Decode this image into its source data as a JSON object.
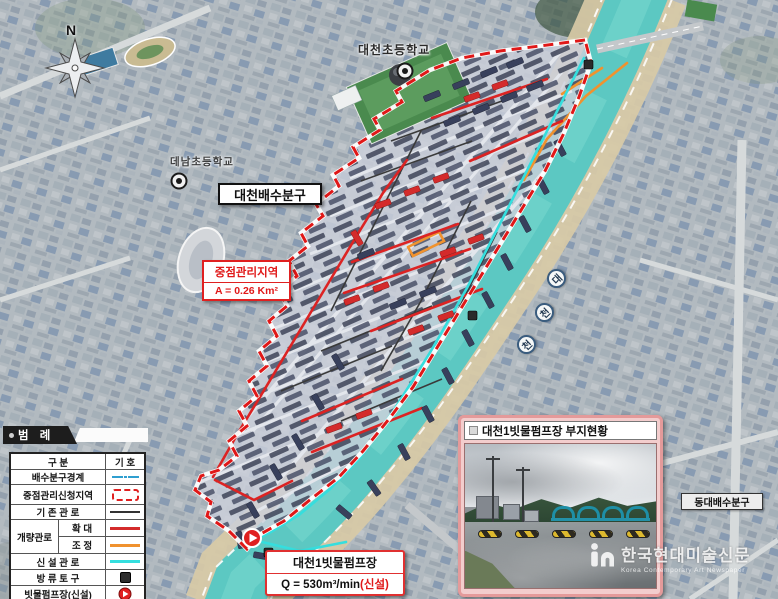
{
  "map": {
    "north": "N",
    "labels": {
      "school_top": "대천초등학교",
      "school_left": "데남초등학교",
      "district_box": "대천배수분구",
      "east_district_box": "동대배수분구"
    },
    "focus_area": {
      "title": "중점관리지역",
      "area": "A = 0.26 Km²"
    },
    "river_badges": [
      "대",
      "천",
      "천"
    ],
    "pump_label": {
      "name": "대천1빗물펌프장",
      "flow": "Q = 530m³/min",
      "flow_new": "(신설)"
    }
  },
  "legend": {
    "title": "범 례",
    "col_category": "구  분",
    "col_symbol": "기  호",
    "rows": {
      "boundary": "배수분구경계",
      "focus_zone": "중점관리신청지역",
      "existing": "기 존 관 로",
      "improved": "개량관로",
      "improved_expand": "확 대",
      "improved_adjust": "조 정",
      "new_pipe": "신 설 관 로",
      "outfall": "방 류 토 구",
      "pump": "빗물펌프장(신설)"
    }
  },
  "photo_inset": {
    "title": "대천1빗물펌프장 부지현황"
  },
  "watermark": {
    "name": "한국현대미술신문",
    "subtitle": "Korea Contemporary Art Newspaper"
  },
  "colors": {
    "boundary_red": "#e02020",
    "improved_red": "#dc2323",
    "adjust_orange": "#f0922e",
    "new_cyan": "#35dede",
    "existing_dark": "#3a3a3a",
    "legend_boundary_blue": "#2f9fd0",
    "river_teal": "#5cc8c2"
  }
}
